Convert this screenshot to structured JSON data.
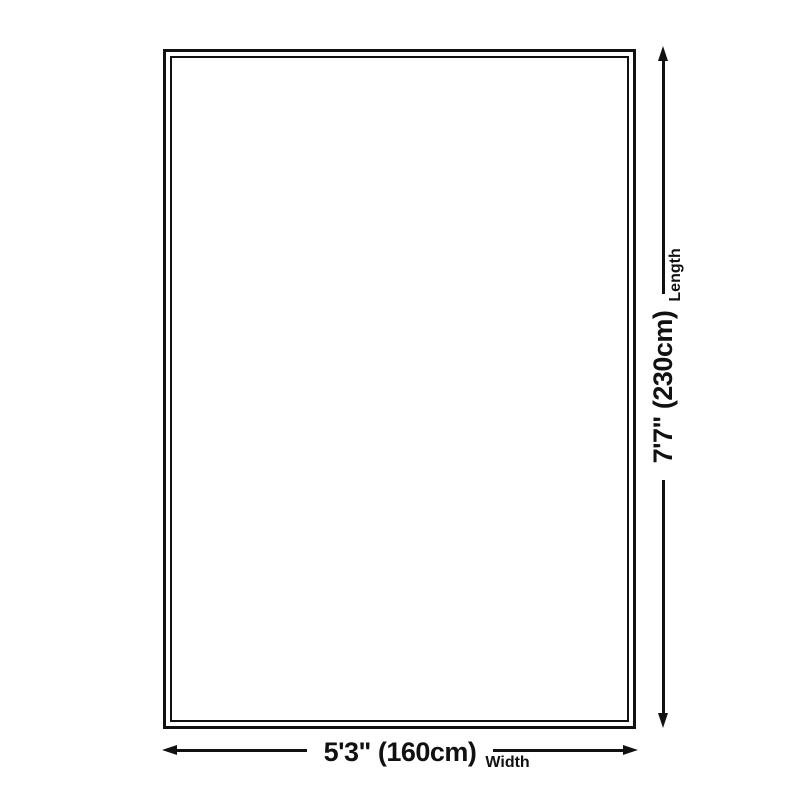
{
  "diagram": {
    "background_color": "#ffffff",
    "line_color": "#111111",
    "width_dimension": {
      "value": "5'3\" (160cm)",
      "axis_label": "Width",
      "arrow_start_icon": "arrow-left",
      "arrow_end_icon": "arrow-right"
    },
    "length_dimension": {
      "value": "7'7\" (230cm)",
      "axis_label": "Length",
      "arrow_start_icon": "arrow-down",
      "arrow_end_icon": "arrow-up"
    }
  }
}
